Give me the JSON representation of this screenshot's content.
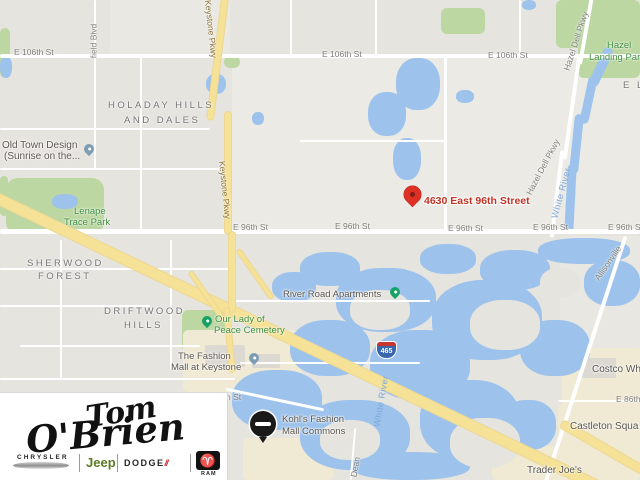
{
  "map": {
    "marker": {
      "label": "4630 East 96th Street"
    },
    "streets": {
      "e106": "E 106th St",
      "e96": "E 96th St",
      "e86": "E 86th",
      "keystone": "Keystone Pkwy",
      "hazel_dell": "Hazel Dell Pkwy",
      "white_river": "White River",
      "field_blvd": "field Blvd",
      "dean": "Dean",
      "allisonville": "Allisonville",
      "i465": "465",
      "h_st": "h St"
    },
    "neighborhoods": {
      "holaday": [
        "HOLADAY HILLS",
        "AND DALES"
      ],
      "sherwood": [
        "SHERWOOD",
        "FOREST"
      ],
      "driftwood": [
        "DRIFTWOOD",
        "HILLS"
      ],
      "partial_el": "E L"
    },
    "pois": {
      "old_town": [
        "Old Town Design",
        "(Sunrise on the..."
      ],
      "lenape": [
        "Lenape",
        "Trace Park"
      ],
      "our_lady": [
        "Our Lady of",
        "Peace Cemetery"
      ],
      "fashion_mall": [
        "The Fashion",
        "Mall at Keystone"
      ],
      "river_road": "River Road Apartments",
      "kohls": [
        "Kohl's Fashion",
        "Mall Commons"
      ],
      "costco": "Costco Wh",
      "castleton": "Castleton Squa",
      "trader_joes": "Trader Joe's",
      "hazel_landing": [
        "Hazel",
        "Landing Par.."
      ]
    }
  },
  "logo": {
    "dealer": [
      "Tom",
      "O'Brien"
    ],
    "brands": {
      "chrysler": "CHRYSLER",
      "jeep": "Jeep",
      "dodge": "DODGE",
      "ram": "RAM"
    }
  },
  "colors": {
    "marker_red": "#de3025",
    "address_red": "#c23325",
    "water_blue": "#9dc3ec",
    "park_green": "#bcd7a2",
    "highway_yellow": "#f6e296",
    "commercial_beige": "#f0e9d3",
    "jeep_green": "#5d7a24",
    "dodge_red": "#d2232a"
  }
}
